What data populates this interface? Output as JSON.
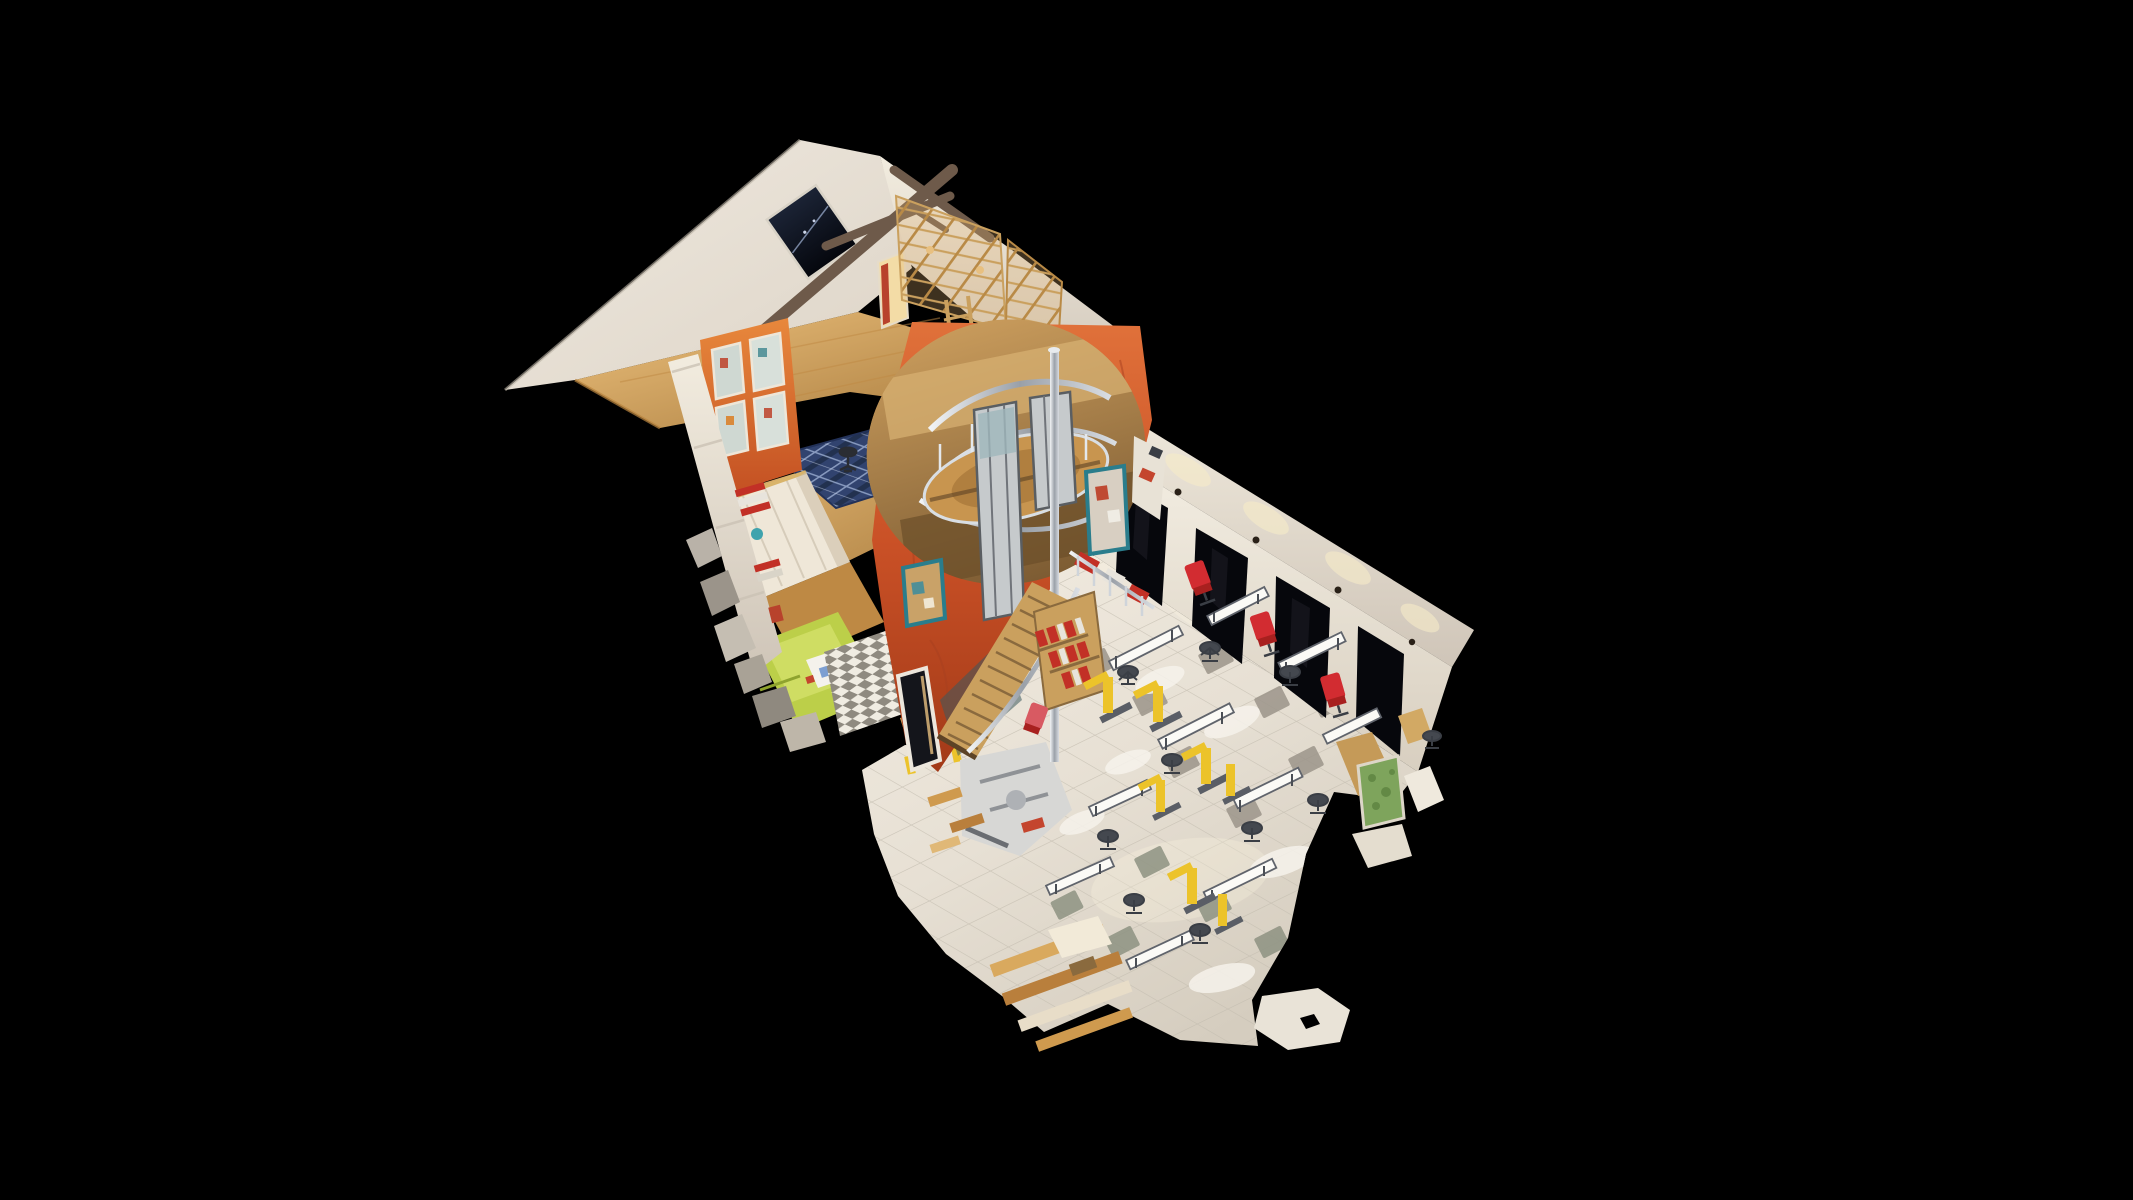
{
  "scene": {
    "label": "Dollhouse cutaway 3D scan of a multi-storey workshop building on a black viewer canvas",
    "view_mode": "dollhouse",
    "parts": {
      "roof": "white gabled roof with dark skylight and timber truss",
      "attic": "attic level with wooden floor and tan shelving racks",
      "arch_wall": "orange cutaway wall with round arch, glazed openings and teal-framed windows",
      "spiral_stair": "spiral stair landing with chrome pole seen through the arch",
      "stairs": "wooden straight staircase with chrome handrail",
      "bookshelf": "shelf stacked with red binders",
      "mid_level": "middle level with glazed orange partition, blue plaid rug and office chairs",
      "cabinets": "cream storage cabinets",
      "green_room": "lime green room at lower left",
      "right_wall": "long white wall with dark door openings and warm spotlights",
      "floor": "light tiled ground-floor hall with accent tiles",
      "machines": "yellow workstation machines",
      "chairs": "red and grey office chairs",
      "debris": "ragged point-cloud scan edges"
    },
    "palette": {
      "background": "#000000",
      "roof_white": "#efe9df",
      "roof_shadow": "#cfc5b8",
      "wood_floor": "#d6a45c",
      "wood_dark": "#a97c3e",
      "orange_wall": "#c95026",
      "orange_light": "#e0713a",
      "orange_dark": "#a23a18",
      "teal_frame": "#2a7d8c",
      "window_dark": "#06070c",
      "rug_blue": "#31436f",
      "rug_line": "#9db0d4",
      "lime_wall": "#bccf49",
      "tile_floor": "#e7e0d4",
      "tile_line": "#c3bcae",
      "tile_accent": "#9c958a",
      "chrome": "#c7ccd3",
      "machine_yellow": "#ecc32a",
      "chair_red": "#d22c31",
      "book_red": "#c23026",
      "lamp_glow": "#f7ecc9",
      "truss_brown": "#6e5a4a",
      "cabinet_cream": "#efe7d8",
      "stair_wood": "#caa05e"
    }
  }
}
